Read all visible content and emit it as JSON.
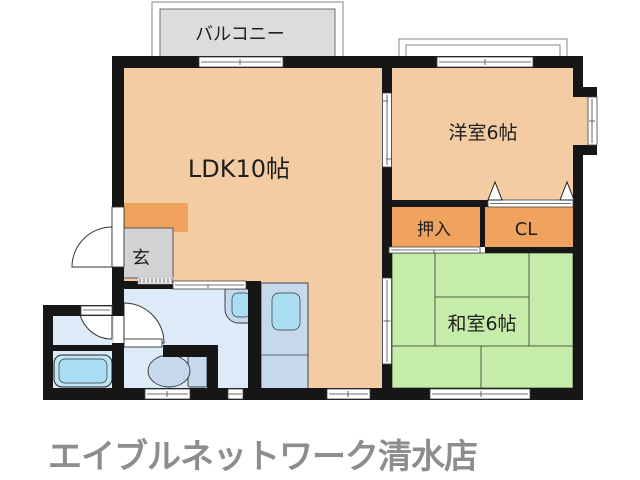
{
  "plan": {
    "labels": {
      "balcony": "バルコニー",
      "ldk": "LDK10帖",
      "western_room": "洋室6帖",
      "oshiire": "押入",
      "closet": "CL",
      "genkan": "玄",
      "japanese_room": "和室6帖"
    },
    "store_name": "エイブルネットワーク清水店",
    "colors": {
      "wall": "#161616",
      "room_peach": "#f4cca4",
      "accent_orange": "#efa35f",
      "tatami_green": "#c5eda9",
      "water_blue": "#dcebf7",
      "fixture_blue": "#c6d9ec",
      "basin_blue": "#a9ddf1",
      "genkan_gray": "#d3d3d3",
      "balcony_gray": "#dcdcdc",
      "store_text_gray": "#8d8d8d"
    }
  }
}
